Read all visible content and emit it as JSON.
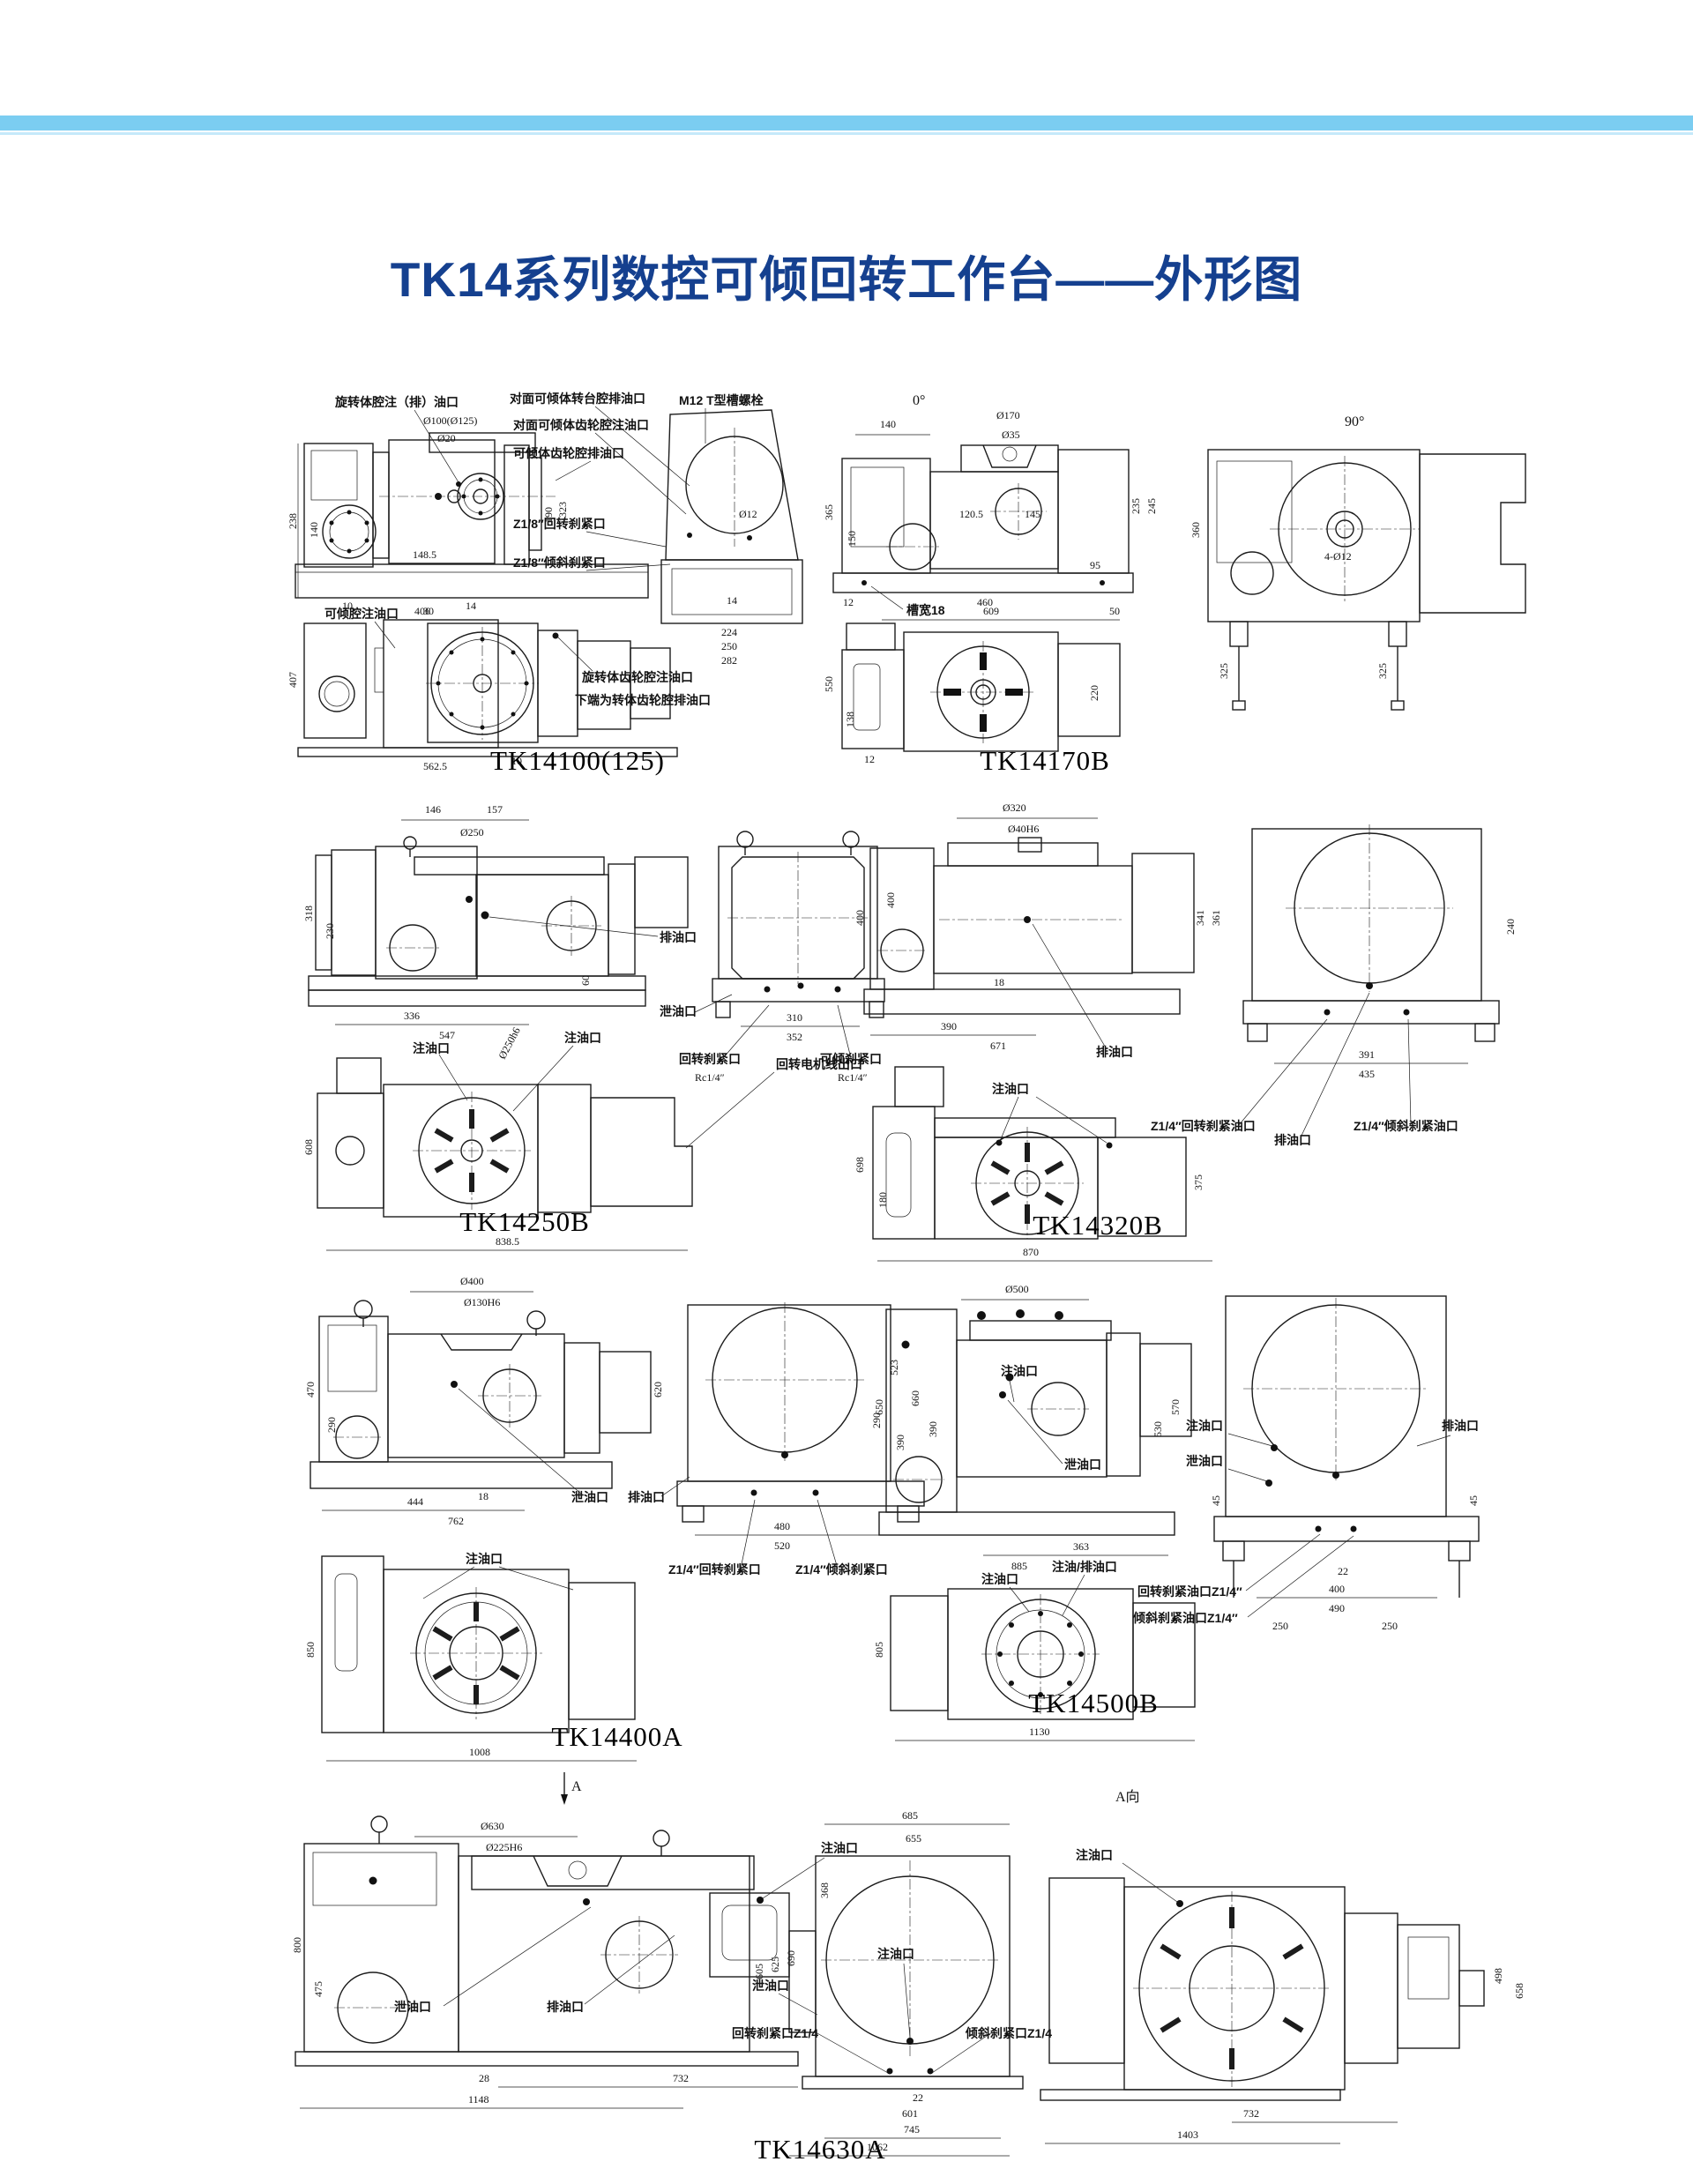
{
  "page": {
    "title": "TK14系列数控可倾回转工作台——外形图",
    "title_color": "#15408f",
    "band_color": "#7bcdf1",
    "line_color": "#1c1c1c"
  },
  "models": {
    "tk14100": {
      "label": "TK14100(125)",
      "callouts": {
        "rotary_fill": "旋转体腔注（排）油口",
        "opp_table_drain": "对面可倾体转台腔排油口",
        "opp_gear_fill": "对面可倾体齿轮腔注油口",
        "tilt_gear_drain": "可倾体齿轮腔排油口",
        "tslot_bolt": "M12 T型槽螺栓",
        "rotary_clamp": "Z1/8″回转刹紧口",
        "tilt_clamp": "Z1/8″倾斜刹紧口",
        "tilt_fill": "可倾腔注油口",
        "rotary_gear_fill": "旋转体齿轮腔注油口",
        "bottom_drain": "下端为转体齿轮腔排油口"
      },
      "dims": {
        "dia": "Ø100(Ø125)",
        "dia20": "Ø20",
        "h238": "238",
        "h140": "140",
        "w148": "148.5",
        "h190": "190",
        "h323": "323",
        "w10": "10",
        "w406": "406",
        "w14": "14",
        "dia12": "Ø12",
        "w14b": "14",
        "w224": "224",
        "w250": "250",
        "w282": "282",
        "h407": "407",
        "w562": "562.5",
        "w10b": "10",
        "w30": "30"
      }
    },
    "tk14170": {
      "label": "TK14170B",
      "view0": "0°",
      "view90": "90°",
      "callouts": {
        "slot": "槽宽18",
        "holes": "4-Ø12"
      },
      "dims": {
        "w140": "140",
        "dia170": "Ø170",
        "dia35": "Ø35",
        "h365": "365",
        "h150": "150",
        "w120": "120.5",
        "w145": "145",
        "h235": "235",
        "h245": "245",
        "w95": "95",
        "h12": "12",
        "w460": "460",
        "h360": "360",
        "h325a": "325",
        "h325b": "325",
        "w609": "609",
        "w50": "50",
        "h550": "550",
        "h138": "138",
        "h12b": "12",
        "h220": "220"
      }
    },
    "tk14250": {
      "label": "TK14250B",
      "callouts": {
        "drain": "排油口",
        "leak": "泄油口",
        "rot_clamp": "回转刹紧口",
        "tilt_clamp": "可倾刹紧口",
        "rc1": "Rc1/4″",
        "rc2": "Rc1/4″",
        "fill1": "注油口",
        "fill2": "注油口",
        "motor": "回转电机线出口"
      },
      "dims": {
        "w146": "146",
        "w157": "157",
        "dia250": "Ø250",
        "h318": "318",
        "h230": "230",
        "w336": "336",
        "w547": "547",
        "h60": "60",
        "h400": "400",
        "w310": "310",
        "w352": "352",
        "h608": "608",
        "w838": "838.5",
        "dia250h6": "Ø250h6"
      }
    },
    "tk14320": {
      "label": "TK14320B",
      "callouts": {
        "drain": "排油口",
        "fill_top": "注油口",
        "rot_clamp": "Z1/4″回转刹紧油口",
        "drain2": "排油口",
        "tilt_clamp": "Z1/4″倾斜刹紧油口",
        "fill_bottom": "注油口"
      },
      "dims": {
        "dia320": "Ø320",
        "dia40": "Ø40H6",
        "h400": "400",
        "h341": "341",
        "h361": "361",
        "w18": "18",
        "w390": "390",
        "w671": "671",
        "h240": "240",
        "w391": "391",
        "w435": "435",
        "h698": "698",
        "h180": "180",
        "w870": "870",
        "h375": "375"
      }
    },
    "tk14400": {
      "label": "TK14400A",
      "callouts": {
        "leak": "泄油口",
        "drain": "排油口",
        "rot_clamp": "Z1/4″回转刹紧口",
        "tilt_clamp": "Z1/4″倾斜刹紧口",
        "fill_bottom": "注油口"
      },
      "dims": {
        "dia400": "Ø400",
        "dia130": "Ø130H6",
        "h470": "470",
        "h290": "290",
        "w444": "444",
        "w762": "762",
        "w18": "18",
        "h620": "620",
        "h523": "523",
        "h290b": "290",
        "h660": "660",
        "h390": "390",
        "w480": "480",
        "w520": "520",
        "h850": "850",
        "w1008": "1008"
      }
    },
    "tk14500": {
      "label": "TK14500B",
      "callouts": {
        "fill_side": "注油口",
        "leak_side": "泄油口",
        "fill_front": "注油口",
        "leak_front": "泄油口",
        "drain_front": "排油口",
        "rot_clamp": "回转刹紧油口Z1/4″",
        "tilt_clamp": "倾斜刹紧油口Z1/4″",
        "fill_bottom": "注油口",
        "fill_drain_bottom": "注油/排油口"
      },
      "dims": {
        "dia500": "Ø500",
        "h650": "650",
        "h390": "390",
        "w363": "363",
        "w885": "885",
        "h570": "570",
        "h530": "530",
        "h45a": "45",
        "h45b": "45",
        "w22": "22",
        "w400": "400",
        "w490": "490",
        "w250a": "250",
        "w250b": "250",
        "h805": "805",
        "w1130": "1130"
      }
    },
    "tk14630": {
      "label": "TK14630A",
      "marker_a": "A",
      "view_a": "A向",
      "callouts": {
        "leak_side": "泄油口",
        "drain_side": "排油口",
        "fill_side": "注油口",
        "fill_front": "注油口",
        "leak_front": "泄油口",
        "rot_clamp": "回转刹紧口Z1/4",
        "tilt_clamp": "倾斜刹紧口Z1/4",
        "fill_a": "注油口"
      },
      "dims": {
        "dia630": "Ø630",
        "dia225": "Ø225H6",
        "h800": "800",
        "h475": "475",
        "w28": "28",
        "w732": "732",
        "w1148": "1148",
        "h605": "605",
        "h625": "625",
        "h690": "690",
        "w685": "685",
        "w655": "655",
        "h368": "368",
        "w22": "22",
        "w601": "601",
        "w745": "745",
        "w1062": "1062",
        "h498": "498",
        "h658": "658",
        "w732b": "732",
        "w1403": "1403"
      }
    }
  }
}
